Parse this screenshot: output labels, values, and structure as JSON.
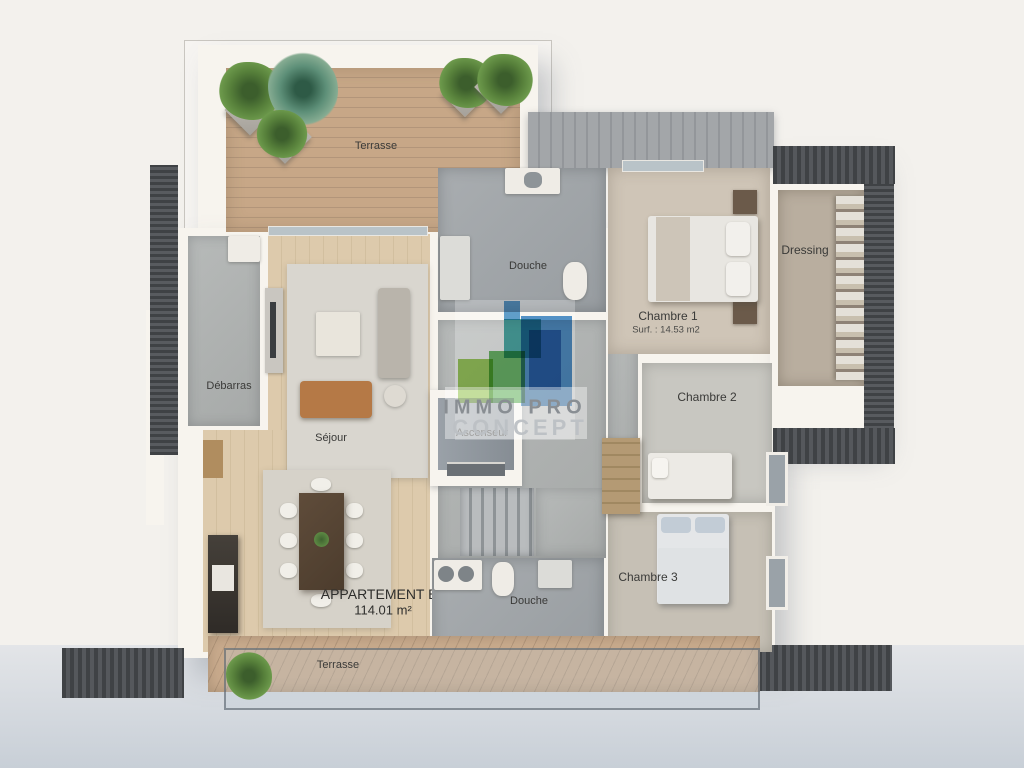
{
  "apartment": {
    "label": "APPARTEMENT B5",
    "area": "114.01 m²"
  },
  "rooms": {
    "terrasse_top": {
      "label": "Terrasse"
    },
    "terrasse_bottom": {
      "label": "Terrasse"
    },
    "douche_top": {
      "label": "Douche"
    },
    "douche_bottom": {
      "label": "Douche"
    },
    "chambre_1": {
      "label": "Chambre 1",
      "surface": "Surf. : 14.53 m2"
    },
    "chambre_2": {
      "label": "Chambre 2"
    },
    "chambre_3": {
      "label": "Chambre 3"
    },
    "dressing": {
      "label": "Dressing"
    },
    "debarras": {
      "label": "Débarras"
    },
    "sejour": {
      "label": "Séjour"
    },
    "ascenseur": {
      "label": "Ascenseur"
    }
  },
  "watermark": {
    "line1": "IMMO PRO",
    "line2": "CONCEPT"
  },
  "colors": {
    "deck_wood": "#c2a284",
    "interior_wood": "#d8c5a6",
    "concrete": "#a3a8ab",
    "carpet_beige": "#cfc5b7",
    "wall_white": "#f7f4ee",
    "roof_dark": "#46484c",
    "ground_blue_gray": "#ccd2d9",
    "logo_green_light": "#8cc63f",
    "logo_green": "#52b04e",
    "logo_teal": "#2ba4a0",
    "logo_blue": "#2f7fc6",
    "sofa_leather": "#b57946"
  }
}
